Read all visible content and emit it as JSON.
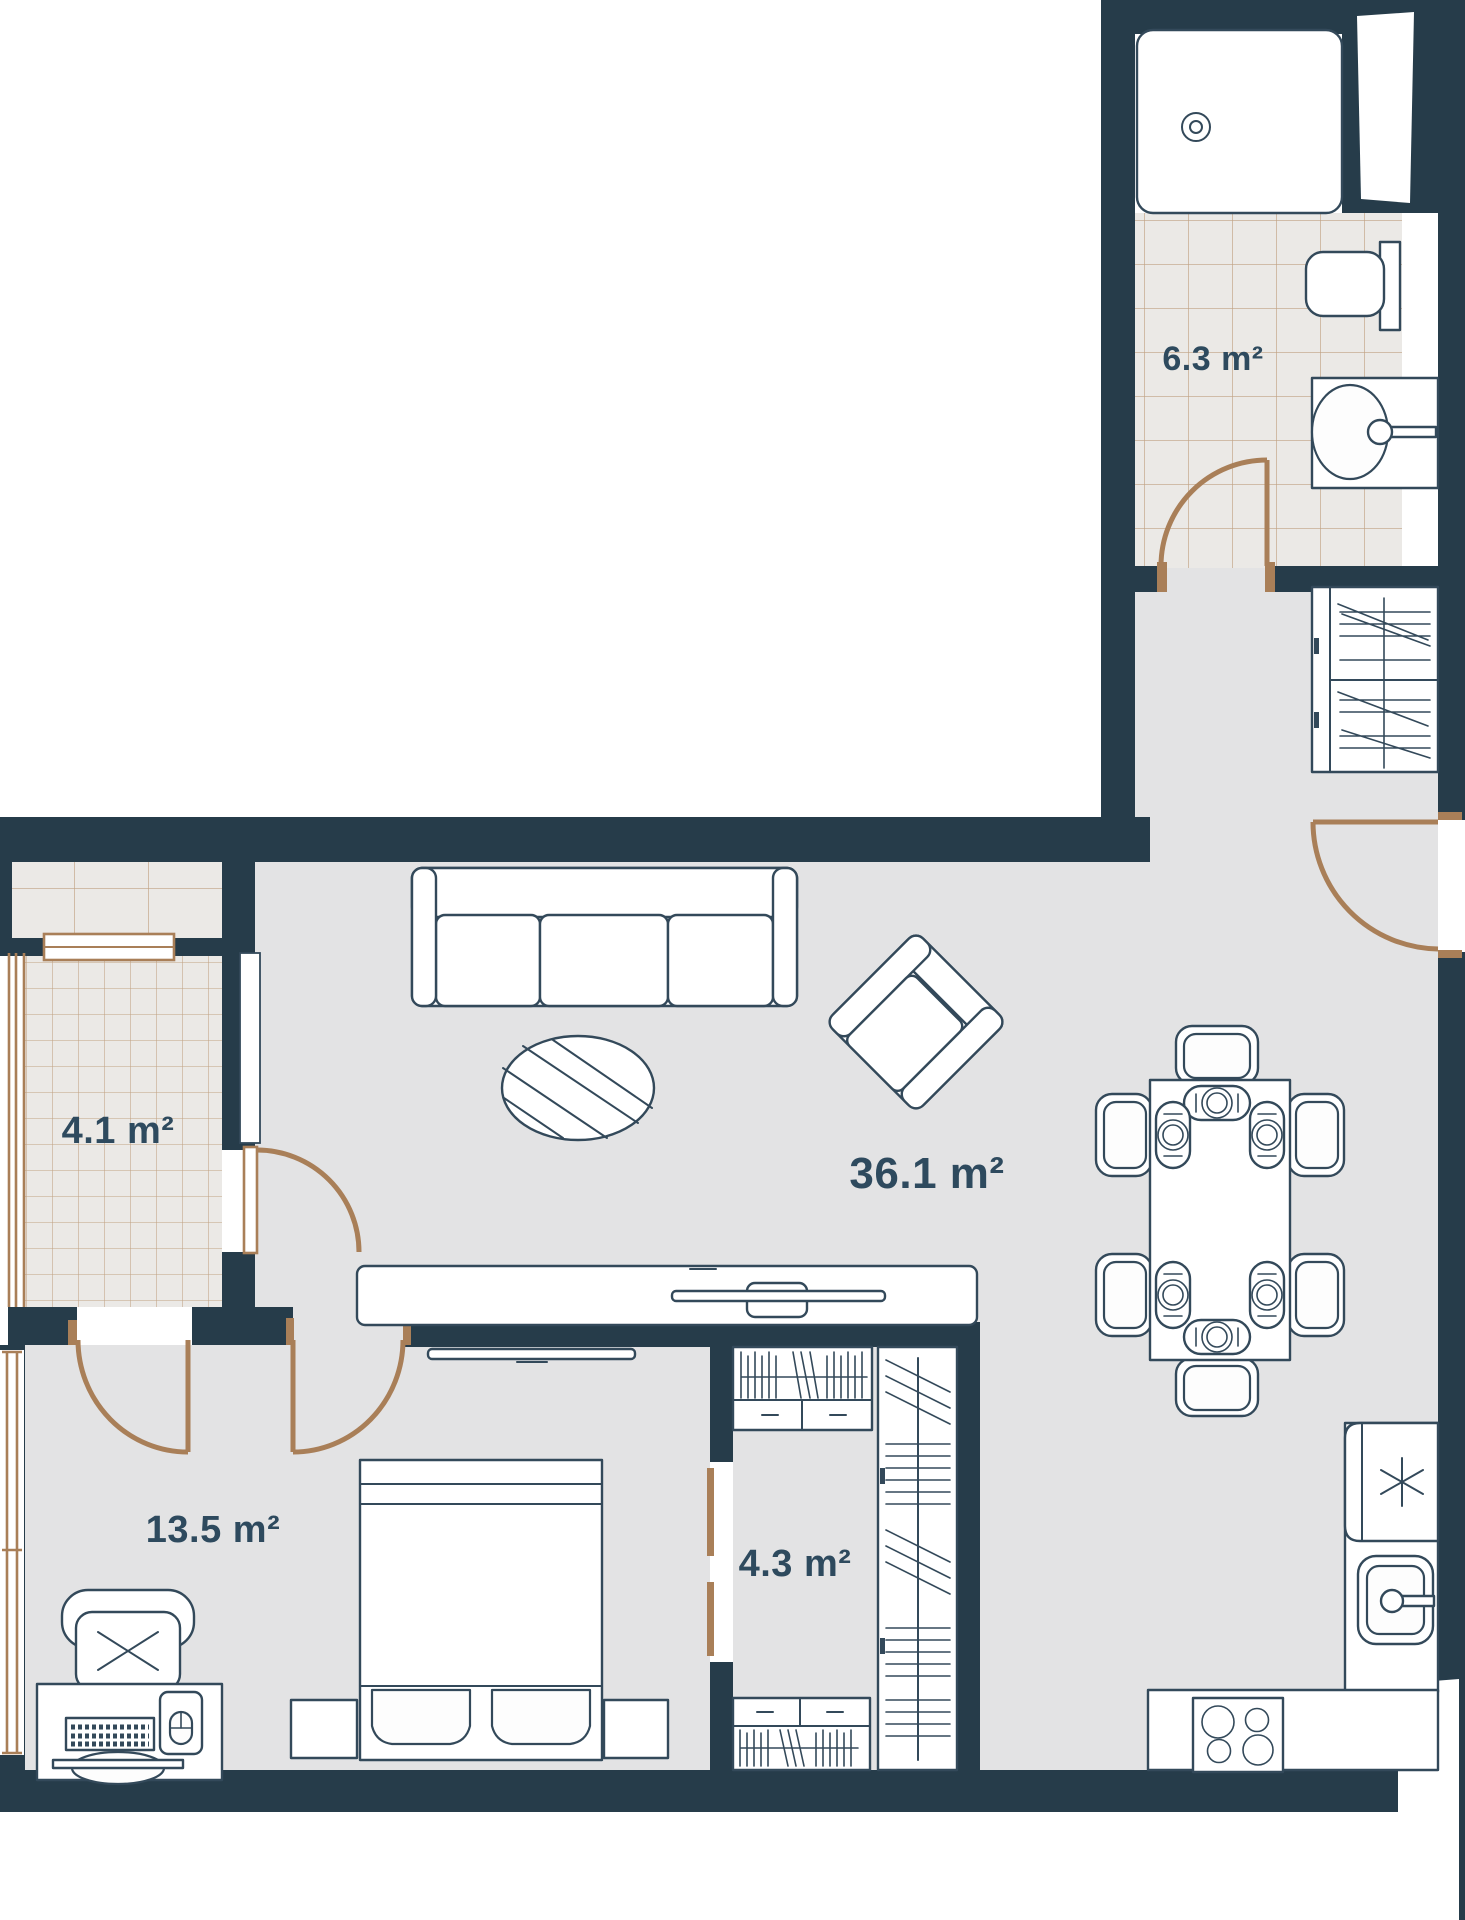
{
  "plan": {
    "type": "apartment-floor-plan",
    "total_rooms_labeled": 5,
    "units": "m²"
  },
  "rooms": [
    {
      "name": "bathroom",
      "area_label": "6.3 m²"
    },
    {
      "name": "balcony",
      "area_label": "4.1 m²"
    },
    {
      "name": "living-dining-room",
      "area_label": "36.1 m²"
    },
    {
      "name": "bedroom",
      "area_label": "13.5 m²"
    },
    {
      "name": "walk-in-closet",
      "area_label": "4.3 m²"
    }
  ],
  "furniture": {
    "bathroom": [
      "bathtub",
      "toilet",
      "vanity-sink",
      "swing-door",
      "window",
      "tiled-floor"
    ],
    "hallway": [
      "wardrobe-with-hanging-clothes",
      "entrance-door"
    ],
    "living_dining": [
      "three-seat-sofa",
      "oval-coffee-table",
      "armchair-rotated",
      "tv-console",
      "tv",
      "dining-table",
      "dining-chairs-count-6",
      "place-settings-count-6"
    ],
    "bedroom": [
      "double-bed",
      "pillows-count-2",
      "nightstands-count-2",
      "desk",
      "keyboard",
      "mouse-pad",
      "monitor",
      "office-chair",
      "wall-tv",
      "window",
      "balcony-door",
      "room-door"
    ],
    "walk_in_closet": [
      "bookshelf-top",
      "bookshelf-bottom",
      "wardrobe-with-hanging-clothes",
      "sliding-door-marks"
    ],
    "kitchen": [
      "refrigerator-with-snowflake-icon",
      "kitchen-sink",
      "cooktop-4-burners",
      "counter",
      "window"
    ],
    "balcony": [
      "tiled-floor",
      "glazing",
      "window",
      "door-to-living-room"
    ]
  },
  "colors": {
    "wall": "#263c4a",
    "floor": "#e3e3e4",
    "tile_floor": "#ebe9e6",
    "tile_line": "#b5906a",
    "door_arc": "#a97f58",
    "furniture_outline": "#33495a",
    "label_text": "#2e4a5e",
    "background": "#ffffff"
  }
}
